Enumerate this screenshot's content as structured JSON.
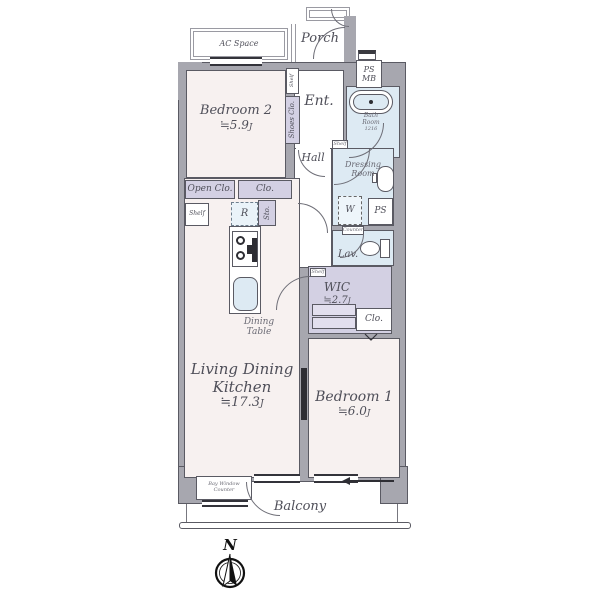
{
  "colors": {
    "wall": "#a7a7af",
    "outline": "#5a5a63",
    "room_pink": "#f7f1f0",
    "closet_purple": "#d3d0e3",
    "wet_blue": "#ddeaf3",
    "text": "#4f4f59",
    "dark": "#2e2e34"
  },
  "rooms": {
    "bedroom2": {
      "name": "Bedroom 2",
      "area_value": "≒5.9",
      "area_unit": "J"
    },
    "ldk": {
      "name_line1": "Living Dining",
      "name_line2": "Kitchen",
      "area_value": "≒17.3",
      "area_unit": "J"
    },
    "bedroom1": {
      "name": "Bedroom 1",
      "area_value": "≒6.0",
      "area_unit": "J"
    },
    "wic": {
      "name": "WIC",
      "area_value": "≒2.7",
      "area_unit": "J"
    }
  },
  "labels": {
    "ac_space": "AC Space",
    "porch": "Porch",
    "ent": "Ent.",
    "hall": "Hall",
    "balcony": "Balcony",
    "ps": "PS",
    "mb": "MB",
    "bath_line1": "Bath",
    "bath_line2": "Room",
    "bath_size": "1216",
    "shelf": "Shelf",
    "shoes_clo": "Shoes Clo.",
    "dressing_line1": "Dressing",
    "dressing_line2": "Room",
    "washer": "W",
    "lav": "Lav.",
    "counter": "Counter",
    "open_clo": "Open Clo.",
    "clo": "Clo.",
    "fridge": "R",
    "sto": "Sto.",
    "dining_line1": "Dining",
    "dining_line2": "Table",
    "bay_window_line1": "Bay Window",
    "bay_window_line2": "Counter",
    "north": "N"
  }
}
